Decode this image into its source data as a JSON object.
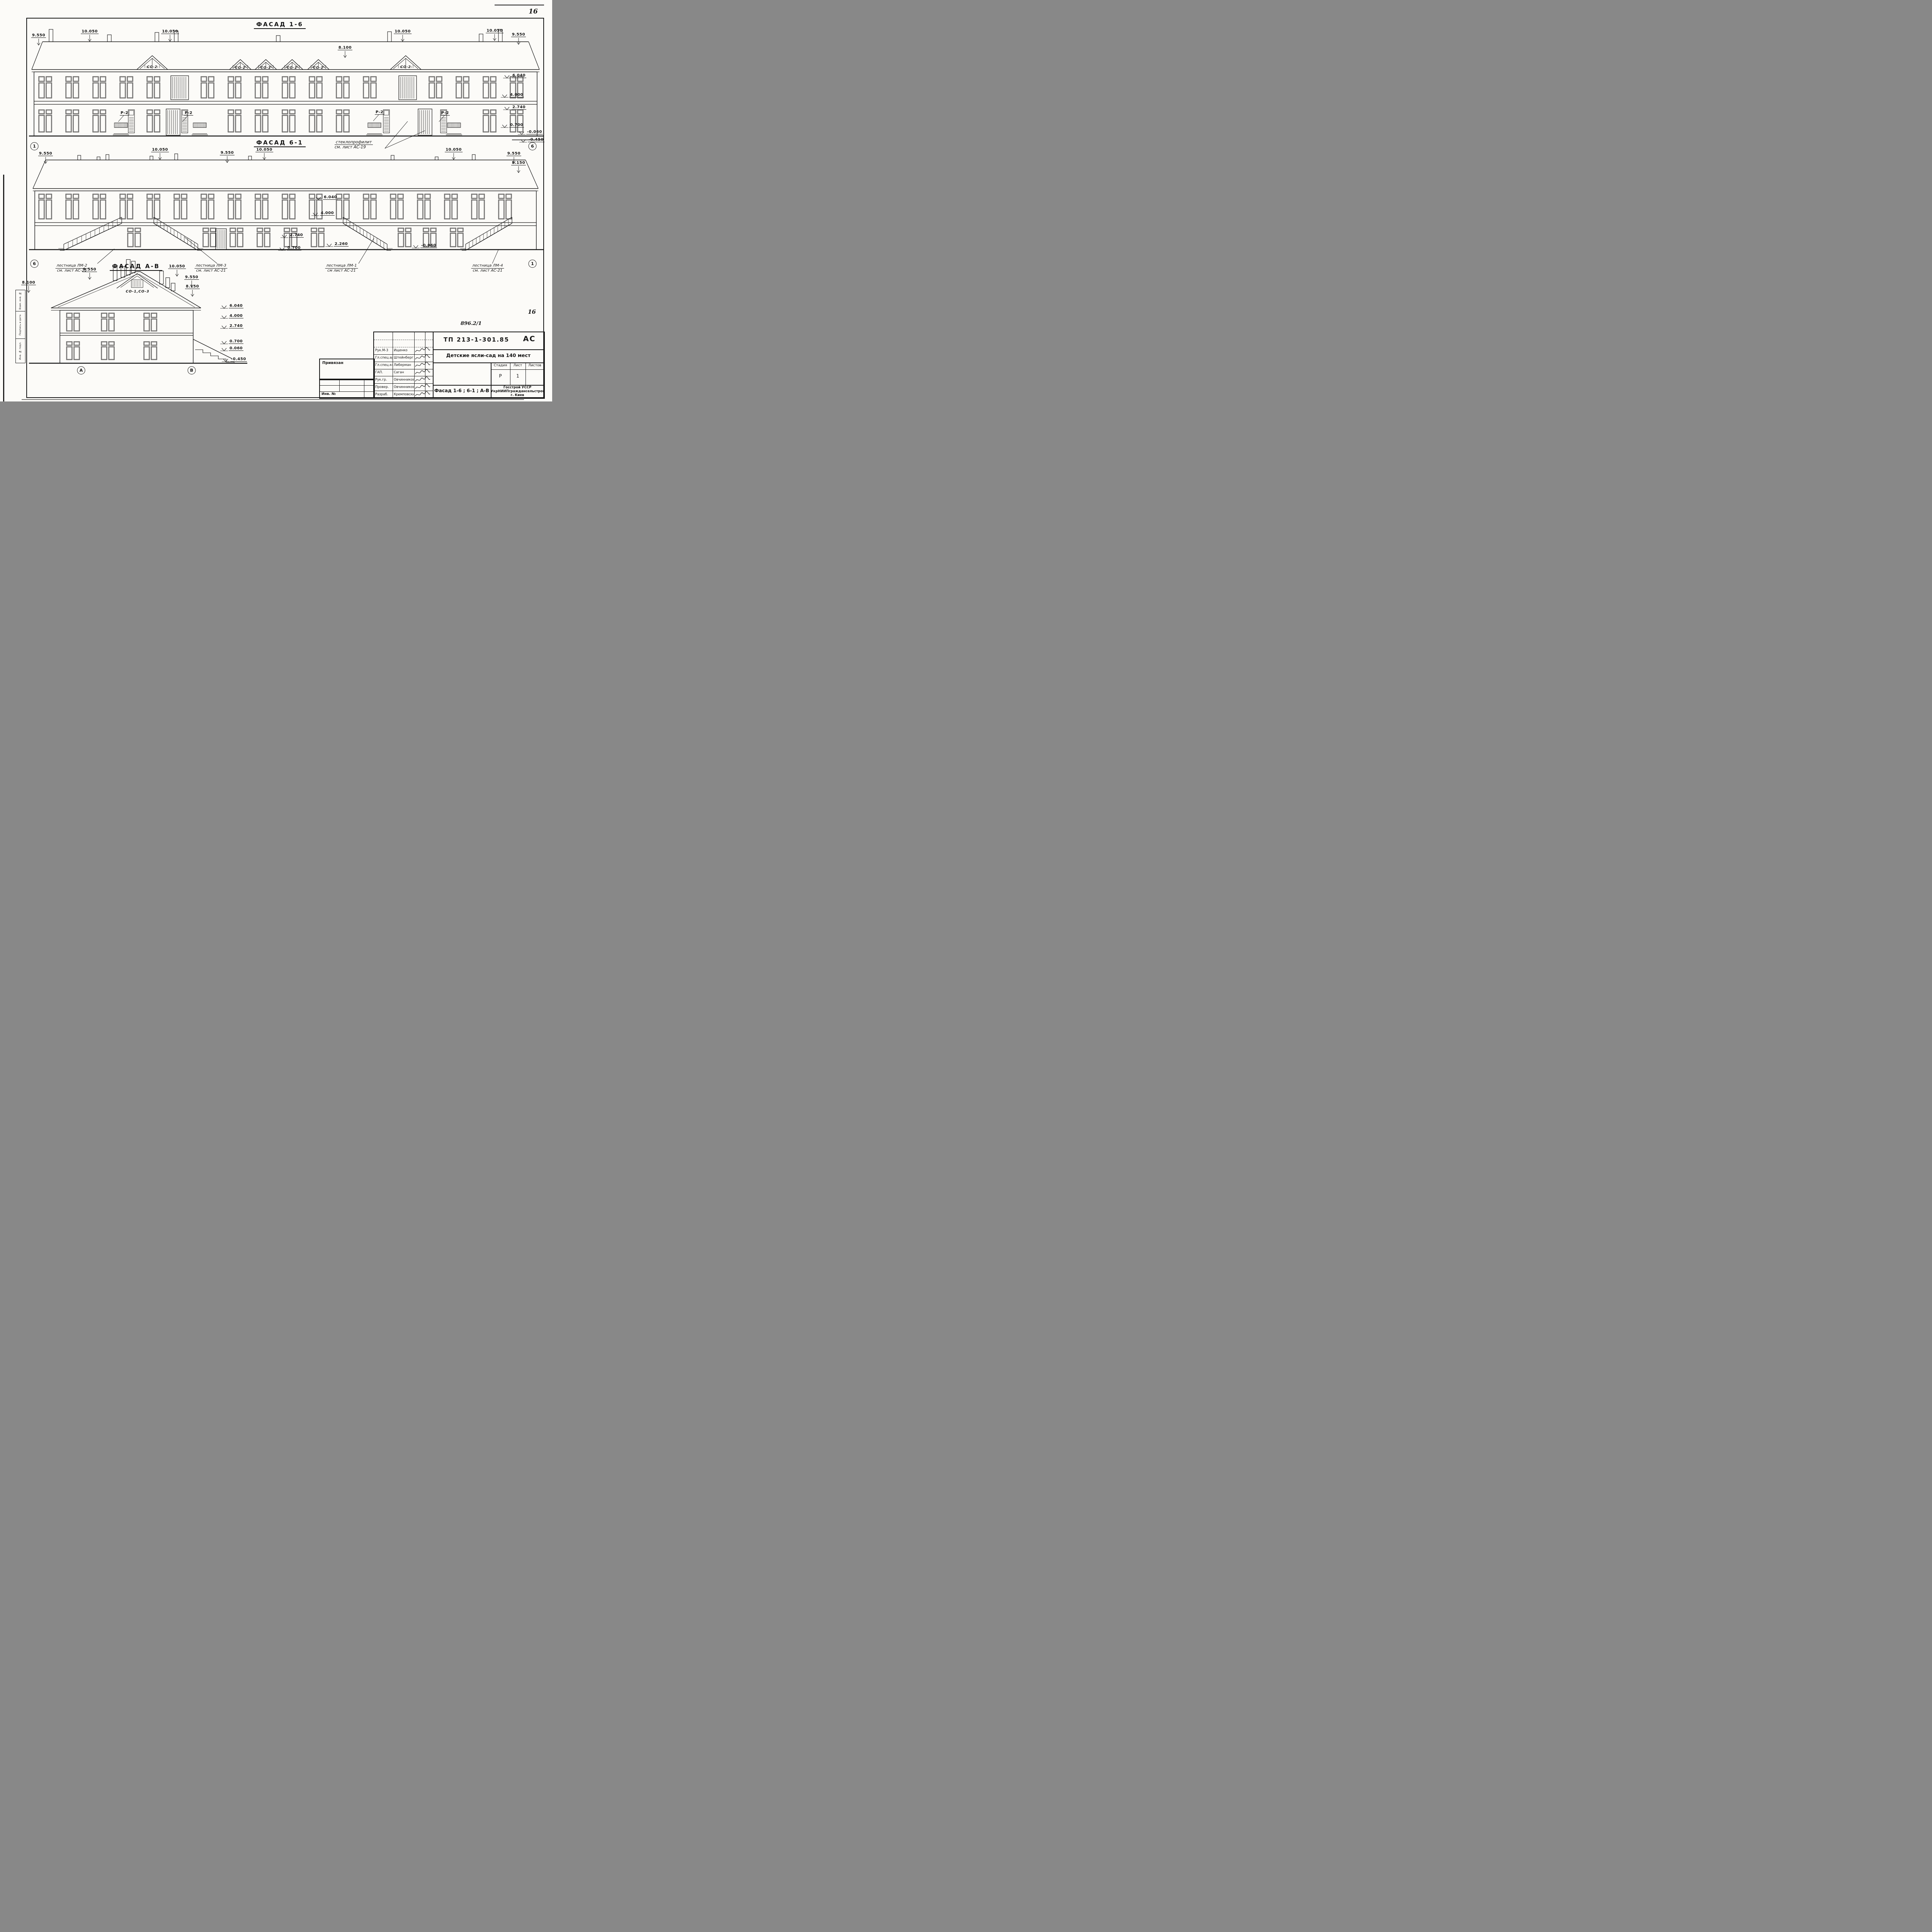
{
  "sheet": {
    "page_number_top": "16",
    "page_number_bottom": "16",
    "doc_number_hand": "896.2/1"
  },
  "facade_1_6": {
    "title": "Фасад 1-6",
    "axis_left": "1",
    "axis_right": "6",
    "dims_top": [
      "9.550",
      "10.050",
      "10.050",
      "8.100",
      "10.050",
      "10.050",
      "9.550"
    ],
    "elevations": [
      "6.040",
      "4.000",
      "2.740",
      "0.700",
      "-0.060",
      "-0.450"
    ],
    "gable_label": "СО-2",
    "window_label": "Р-2"
  },
  "facade_6_1": {
    "title": "Фасад 6-1",
    "axis_left": "6",
    "axis_right": "1",
    "note": {
      "line1": "стеклопрофилит",
      "line2": "см. лист АС-19"
    },
    "dims_top": [
      "9.550",
      "10.050",
      "9.550",
      "10.050",
      "10.050",
      "9.550",
      "8.150"
    ],
    "elevations": [
      "6.040",
      "4.000",
      "2.740",
      "2.260",
      "0.700",
      "-0.060"
    ],
    "stairs": [
      {
        "line1": "лестница ЛМ-2",
        "line2": "см. лист АС-21"
      },
      {
        "line1": "лестница ЛМ-3",
        "line2": "см. лист АС-21"
      },
      {
        "line1": "лестница ЛМ-1",
        "line2": "см лист АС-21"
      },
      {
        "line1": "лестница ЛМ-4",
        "line2": "см. лист АС-21"
      }
    ]
  },
  "facade_a_v": {
    "title": "Фасад А-В",
    "axis_left": "А",
    "axis_right": "В",
    "gable_label": "СО-1,СО-3",
    "dims": [
      "8.100",
      "9.550",
      "10.050",
      "9.550",
      "8.150"
    ],
    "elevations": [
      "6.040",
      "4.000",
      "2.740",
      "0.700",
      "0.060",
      "-0.450"
    ]
  },
  "title_block": {
    "doc_code": "ТП 213-1-301.85",
    "doc_type": "АС",
    "project_title": "Детские ясли-сад на 140 мест",
    "sheet_title": "Фасад 1-6 ; 6-1 ; А-В",
    "stage_label": "Стадия",
    "sheet_label": "Лист",
    "sheets_label": "Листов",
    "stage": "Р",
    "sheet": "1",
    "org_line1": "Госстрой УССР",
    "org_line2": "УкрНИИПграждансельстрой",
    "org_line3": "г. Киев",
    "roles": [
      {
        "role": "Рук.М-3",
        "name": "Ищенко"
      },
      {
        "role": "Гл.спец.арх",
        "name": "Штейнберг"
      },
      {
        "role": "Гл.спец.кон",
        "name": "Либерман"
      },
      {
        "role": "ГАП.",
        "name": "Саган"
      },
      {
        "role": "Рук.гр.",
        "name": "Овчинникова"
      },
      {
        "role": "Провер.",
        "name": "Овчинникова"
      },
      {
        "role": "Разраб.",
        "name": "Кремповский"
      }
    ],
    "linked_label": "Привязан",
    "inventory_label": "Инв. №"
  },
  "side_stamp": {
    "cells": [
      "Взам. инв. №",
      "Подпись и дата",
      "Инв. № подл."
    ]
  }
}
